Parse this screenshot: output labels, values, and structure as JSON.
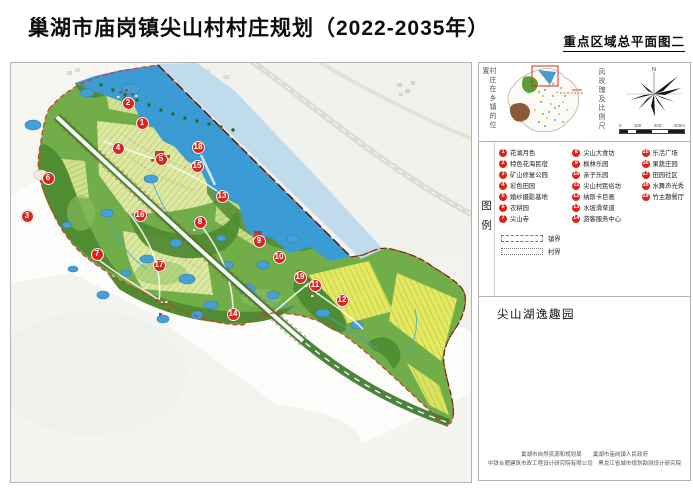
{
  "page": {
    "title": "巢湖市庙岗镇尖山村村庄规划（2022-2035年）",
    "subtitle": "重点区域总平面图二"
  },
  "sidebar": {
    "locator_label": "村庄在乡镇的位置",
    "windrose_label": "风玫瑰及比例尺",
    "north_label": "N",
    "scale_ticks": [
      "0",
      "100",
      "200",
      "400m"
    ],
    "legend_title": "图例",
    "legend_items": [
      {
        "num": "1",
        "label": "花湖月色"
      },
      {
        "num": "2",
        "label": "特色花海民宿"
      },
      {
        "num": "3",
        "label": "矿山修复公园"
      },
      {
        "num": "4",
        "label": "彩色田园"
      },
      {
        "num": "5",
        "label": "婚纱摄影基地"
      },
      {
        "num": "6",
        "label": "农耕园"
      },
      {
        "num": "7",
        "label": "尖山寺"
      },
      {
        "num": "8",
        "label": "尖山大食坊"
      },
      {
        "num": "9",
        "label": "枫林乐园"
      },
      {
        "num": "10",
        "label": "亲子乐园"
      },
      {
        "num": "11",
        "label": "尖山村民俗坊"
      },
      {
        "num": "12",
        "label": "纳斯卡巨画"
      },
      {
        "num": "13",
        "label": "水坡滑草道"
      },
      {
        "num": "14",
        "label": "游客服务中心"
      },
      {
        "num": "15",
        "label": "乐活广场"
      },
      {
        "num": "16",
        "label": "果蔬庄园"
      },
      {
        "num": "17",
        "label": "田园社区"
      },
      {
        "num": "18",
        "label": "水舞声光秀"
      },
      {
        "num": "19",
        "label": "竹主题餐厅"
      }
    ],
    "boundary_items": [
      {
        "label": "镇界"
      },
      {
        "label": "村界"
      }
    ],
    "section_title": "尖山湖逸趣园",
    "footer_line1": "巢湖市自然资源和规划局　　巢湖市庙岗镇人民政府",
    "footer_line2": "中铁合肥建筑市政工程设计研究院有限公司　黑龙江省城市规划勘测设计研究院"
  },
  "map": {
    "name": "尖山村重点区域总平面图",
    "colors": {
      "marker_red": "#d8261a",
      "lake_blue": "#3b9bd5",
      "hill_green": "#71ae49",
      "farmland": "#dfe9a4",
      "boundary_red": "#d8382a"
    },
    "markers": [
      {
        "num": "1",
        "label": "花湖月色",
        "x": 131,
        "y": 60
      },
      {
        "num": "2",
        "label": "特色花海民宿",
        "x": 117,
        "y": 40
      },
      {
        "num": "3",
        "label": "矿山修复公园",
        "x": 16,
        "y": 153
      },
      {
        "num": "4",
        "label": "彩色田园",
        "x": 107,
        "y": 85
      },
      {
        "num": "5",
        "label": "婚纱摄影基地",
        "x": 150,
        "y": 96
      },
      {
        "num": "6",
        "label": "农耕园",
        "x": 37,
        "y": 115
      },
      {
        "num": "7",
        "label": "尖山寺",
        "x": 86,
        "y": 191
      },
      {
        "num": "8",
        "label": "尖山大食坊",
        "x": 189,
        "y": 159
      },
      {
        "num": "9",
        "label": "枫林乐园",
        "x": 248,
        "y": 178
      },
      {
        "num": "10",
        "label": "亲子乐园",
        "x": 268,
        "y": 194
      },
      {
        "num": "11",
        "label": "尖山村民俗坊",
        "x": 304,
        "y": 222
      },
      {
        "num": "12",
        "label": "纳斯卡巨画",
        "x": 331,
        "y": 237
      },
      {
        "num": "13",
        "label": "水坡滑草道",
        "x": 211,
        "y": 133
      },
      {
        "num": "14",
        "label": "游客服务中心",
        "x": 222,
        "y": 251
      },
      {
        "num": "15",
        "label": "乐活广场",
        "x": 186,
        "y": 103
      },
      {
        "num": "16",
        "label": "果蔬庄园",
        "x": 129,
        "y": 152
      },
      {
        "num": "17",
        "label": "田园社区",
        "x": 148,
        "y": 202
      },
      {
        "num": "18",
        "label": "水舞声光秀",
        "x": 187,
        "y": 84
      },
      {
        "num": "19",
        "label": "竹主题餐厅",
        "x": 289,
        "y": 214
      }
    ]
  }
}
